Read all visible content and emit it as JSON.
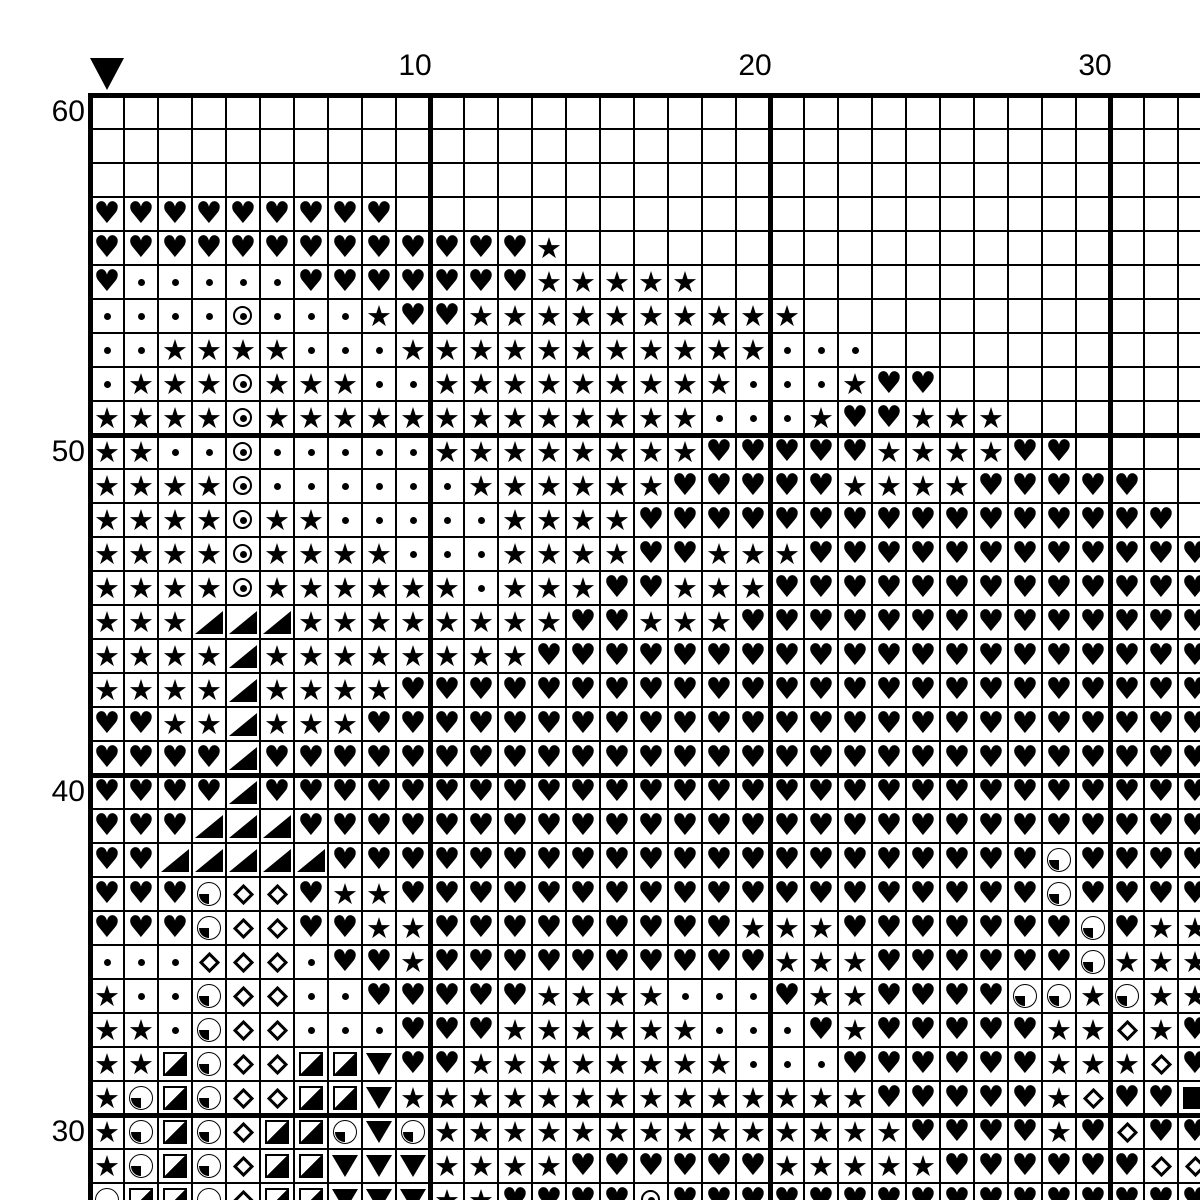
{
  "page": {
    "background": "#ffffff",
    "ink": "#000000"
  },
  "chart": {
    "type": "cross-stitch-pattern-grid",
    "marker": {
      "symbol": "down-triangle",
      "col": 1
    },
    "col_labels": [
      {
        "text": "10",
        "col": 10
      },
      {
        "text": "20",
        "col": 20
      },
      {
        "text": "30",
        "col": 30
      }
    ],
    "row_labels": [
      {
        "text": "60",
        "row": 60
      },
      {
        "text": "50",
        "row": 50
      },
      {
        "text": "40",
        "row": 40
      },
      {
        "text": "30",
        "row": 30
      }
    ],
    "grid": {
      "visible_cols": 33,
      "visible_rows": 33,
      "top_row_number": 60,
      "bold_rule_every": 10,
      "cell_px": 34
    },
    "symbols": {
      ".": {
        "name": "empty"
      },
      "H": {
        "name": "heart",
        "glyph": "♥"
      },
      "S": {
        "name": "star",
        "glyph": "★"
      },
      "d": {
        "name": "dot"
      },
      "O": {
        "name": "circled-dot"
      },
      "T": {
        "name": "lower-right-triangle"
      },
      "D": {
        "name": "diamond-outline"
      },
      "P": {
        "name": "quarter-pie-circle"
      },
      "Q": {
        "name": "half-filled-square"
      },
      "V": {
        "name": "down-triangle"
      },
      "B": {
        "name": "filled-square"
      }
    },
    "rows": [
      ".................................",
      ".................................",
      ".................................",
      "HHHHHHHHH........................",
      "HHHHHHHHHHHHHS...................",
      "HdddddHHHHHHHSSSSS...............",
      "ddddOdddSHHSSSSSSSSSS............",
      "ddSSSSdddSSSSSSSSSSSddd..........",
      "dSSSOSSSddSSSSSSSSSdddSHH........",
      "SSSSOSSSSSSSSSSSSSdddSHHSSS......",
      "SSddOdddddSSSSSSSSHHHHHSSSSHH....",
      "SSSSOddddddSSSSSSHHHHHSSSSHHHHH..",
      "SSSSOSSdddddSSSSHHHHHHHHHHHHHHHH.",
      "SSSSOSSSSdddSSSSHHSSSHHHHHHHHHHHH",
      "SSSSOSSSSSSdSSSHHSSSHHHHHHHHHHHHH",
      "SSSTTTSSSSSSSSHHSSSHHHHHHHHHHHHHH",
      "SSSSTSSSSSSSSHHHHHHHHHHHHHHHHHHHH",
      "SSSSTSSSSHHHHHHHHHHHHHHHHHHHHHHHH",
      "HHSSTSSSHHHHHHHHHHHHHHHHHHHHHHHHH",
      "HHHHTHHHHHHHHHHHHHHHHHHHHHHHHHHHH",
      "HHHHTHHHHHHHHHHHHHHHHHHHHHHHHHHHH",
      "HHHTTTHHHHHHHHHHHHHHHHHHHHHHHHHHH",
      "HHTTTTTHHHHHHHHHHHHHHHHHHHHHPHHHH",
      "HHHPDDHSSHHHHHHHHHHHHHHHHHHHPHHHH",
      "HHHPDDHHSSHHHHHHHHHSSSHHHHHHHPHSS",
      "dddDDDdHHSHHHHHHHHHHSSSHHHHHHPSSS",
      "SddPDDddHHHHHSSSSdddHSSHHHHPPSPSS",
      "SSdPDDdddHHHSSSSSSdddHSHHHHHSSDSH",
      "SSQPDDQQVHHSSSSSSSSdddHHHHHHSSSDH",
      "SPQPDDQQVSSSSSSSSSSSSSSHHHHHSDHHB",
      "SPQPDQQPVPSSSSSSSSSSSSSSHHHHSHDHH",
      "SPQPDQQVVVSSSSHHHHHHSSSSSHHHHHHDD",
      "PQQPDQQVVVSSHHHHOHHHHHHHHHHHHHHHH"
    ]
  }
}
